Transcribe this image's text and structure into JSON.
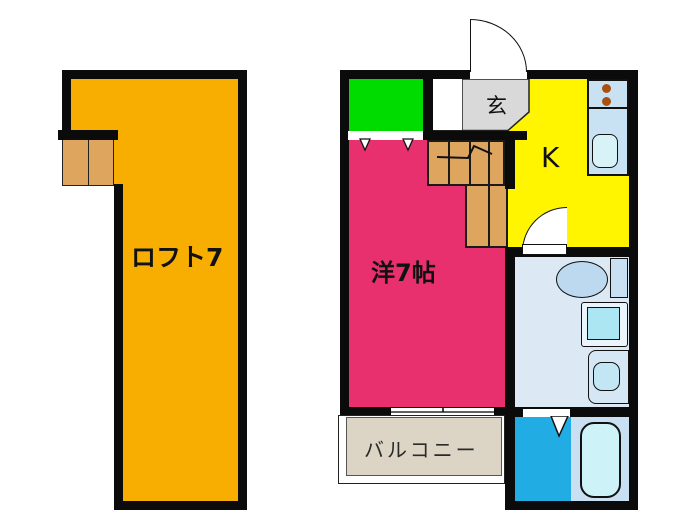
{
  "plan_title": "apartment-floor-plan",
  "rooms": {
    "loft": {
      "label": "ロフト7",
      "floor_color": "#F7AE00"
    },
    "entrance": {
      "label": "玄",
      "floor_color": "#D9D9D9"
    },
    "kitchen": {
      "label": "K",
      "floor_color": "#FFF500"
    },
    "western": {
      "label": "洋7帖",
      "floor_color": "#E8306E"
    },
    "balcony": {
      "label": "バルコニー",
      "floor_color": "#DCD5C6"
    },
    "closet": {
      "floor_color": "#00DC00"
    },
    "sanitary": {
      "floor_color": "#DCE9F5"
    },
    "shower": {
      "floor_color": "#22ACE4"
    }
  },
  "fixtures": {
    "stairs_color": "#DEA55F",
    "storage_color": "#DEA55F",
    "counter_color": "#C8E2F4",
    "sink_color": "#D7F3F7",
    "burner_color": "#A85010",
    "tub_color": "#CDF3F9",
    "washer_drum_color": "#ACE6F2",
    "wall_color": "#0B0B0B",
    "icons": [
      "entrance-door-arc",
      "interior-door-arc",
      "folding-door-mark",
      "sliding-window",
      "stairs-arrow",
      "toilet",
      "washing-machine",
      "vanity-sink",
      "bathtub",
      "stove-burners",
      "kitchen-sink"
    ]
  }
}
